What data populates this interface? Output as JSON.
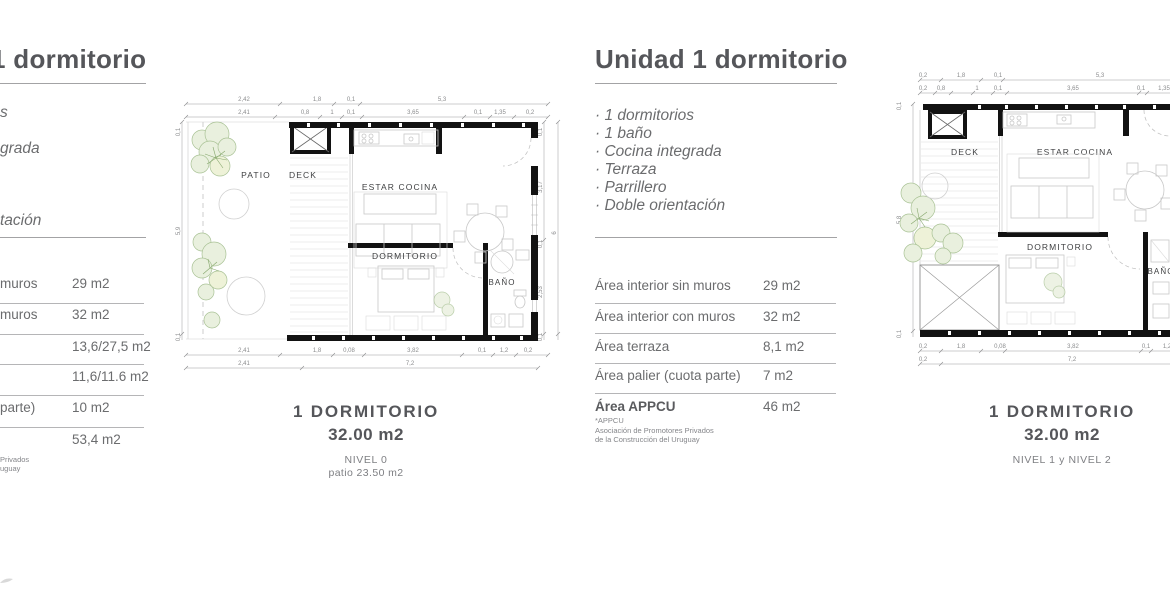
{
  "left_panel": {
    "title": "1 dormitorio",
    "bullets": [
      "s",
      "grada",
      "tación"
    ],
    "rows": [
      {
        "label": "muros",
        "value": "29 m2"
      },
      {
        "label": "muros",
        "value": "32 m2"
      },
      {
        "label": "",
        "value": "13,6/27,5 m2"
      },
      {
        "label": "",
        "value": "11,6/11.6 m2"
      },
      {
        "label": "parte)",
        "value": "10 m2"
      },
      {
        "label": "",
        "value": "53,4 m2"
      }
    ],
    "footnote": [
      "Privados",
      "uguay"
    ]
  },
  "center_panel": {
    "title": "Unidad 1 dormitorio",
    "bullets": [
      "· 1 dormitorios",
      "· 1 baño",
      "· Cocina integrada",
      "· Terraza",
      "· Parrillero",
      "· Doble orientación"
    ],
    "rows": [
      {
        "label": "Área interior sin muros",
        "value": "29 m2"
      },
      {
        "label": "Área interior con muros",
        "value": "32 m2"
      },
      {
        "label": "Área terraza",
        "value": "8,1 m2"
      },
      {
        "label": "Área palier (cuota parte)",
        "value": "7 m2"
      }
    ],
    "appcu": {
      "label": "Área APPCU",
      "value": "46 m2",
      "footnote": [
        "*APPCU",
        "Asociación de Promotores Privados",
        "de la Construcción del Uruguay"
      ]
    }
  },
  "plan_a": {
    "rooms": {
      "patio": "PATIO",
      "deck": "DECK",
      "estar": "ESTAR COCINA",
      "dormitorio": "DORMITORIO",
      "bano": "BAÑO"
    },
    "dims": {
      "top1": [
        "2,42",
        "1,8",
        "0,1",
        "5,3"
      ],
      "top2": [
        "2,41",
        "0,8",
        "1",
        "0,1",
        "3,65",
        "0,1",
        "1,35",
        "0,2"
      ],
      "bottom1": [
        "2,41",
        "1,8",
        "0,08",
        "3,82",
        "0,1",
        "1,2",
        "0,2"
      ],
      "bottom2": [
        "2,41",
        "7,2"
      ],
      "left": [
        "0,1",
        "5,9",
        "0,1"
      ],
      "right": [
        "0,1",
        "3,17",
        "0,1",
        "2,53",
        "0,1"
      ],
      "right_total": "6"
    },
    "caption": {
      "title": "1 DORMITORIO",
      "area": "32.00 m2",
      "level": "NIVEL 0",
      "extra": "patio 23.50 m2"
    }
  },
  "plan_b": {
    "rooms": {
      "deck": "DECK",
      "estar": "ESTAR COCINA",
      "dormitorio": "DORMITORIO",
      "bano": "BAÑO"
    },
    "dims": {
      "top1": [
        "0,2",
        "1,8",
        "0,1",
        "5,3"
      ],
      "top2": [
        "0,2",
        "0,8",
        "1",
        "0,1",
        "3,65",
        "0,1",
        "1,35"
      ],
      "bottom1": [
        "0,2",
        "1,8",
        "0,08",
        "3,82",
        "0,1",
        "1,2"
      ],
      "bottom2": [
        "0,2",
        "7,2"
      ],
      "left": [
        "0,1",
        "5,8",
        "0,1"
      ]
    },
    "caption": {
      "title": "1 DORMITORIO",
      "area": "32.00 m2",
      "level": "NIVEL 1 y NIVEL 2"
    }
  }
}
